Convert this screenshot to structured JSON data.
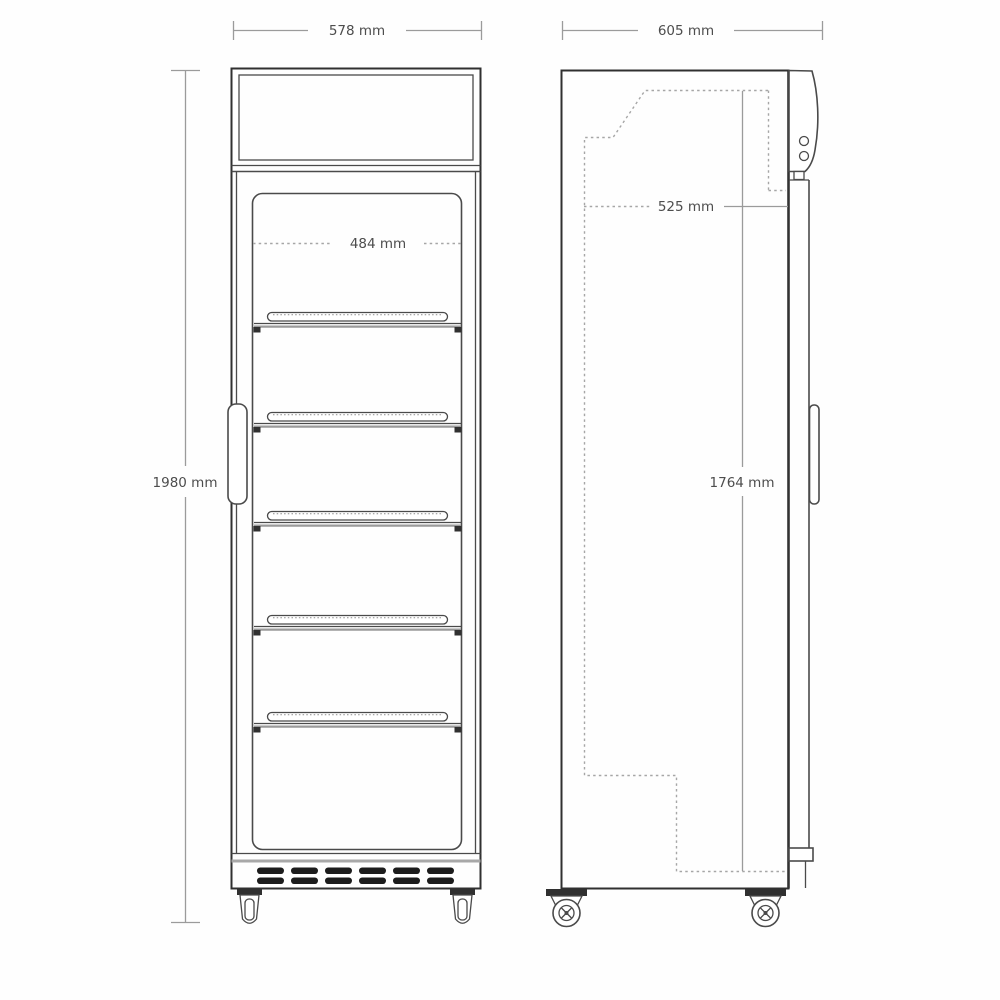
{
  "dimensions": {
    "front_width": "578 mm",
    "depth": "605 mm",
    "height": "1980 mm",
    "glass_width": "484 mm",
    "internal_depth": "525 mm",
    "internal_height": "1764 mm"
  },
  "colors": {
    "line": "#4a4a4a",
    "line_dark": "#303030",
    "dim_line": "#9b9b9b",
    "dotted": "#a6a6a6",
    "text": "#4d4d4d",
    "grille": "#1c1c1c",
    "background": "#fefefe"
  }
}
